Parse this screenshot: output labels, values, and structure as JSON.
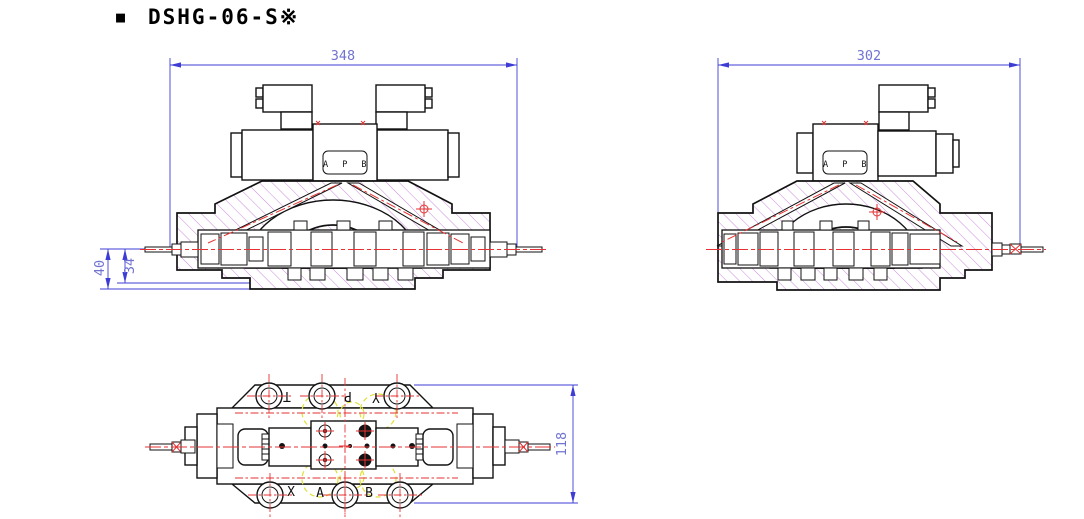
{
  "title": {
    "bullet": "■",
    "text": "DSHG-06-S※"
  },
  "views": {
    "front_double": {
      "dim_width": "348",
      "dim_height_outer": "40",
      "dim_height_inner": "34",
      "port_label": "A P B"
    },
    "front_single": {
      "dim_width": "302",
      "port_label": "A P B"
    },
    "top": {
      "dim_height": "118",
      "ports_top": [
        "T",
        "P",
        "Y"
      ],
      "ports_bottom": [
        "X",
        "A",
        "B"
      ]
    }
  },
  "colors": {
    "outline": "#121212",
    "dimension_line": "#3d3dd6",
    "dimension_text": "#7173d1",
    "centerline_red": "#e63232",
    "hatch_purple": "#c77fd9",
    "spool_magenta": "#ee4fee",
    "hidden_yellow": "#e0e038",
    "background": "#ffffff"
  }
}
